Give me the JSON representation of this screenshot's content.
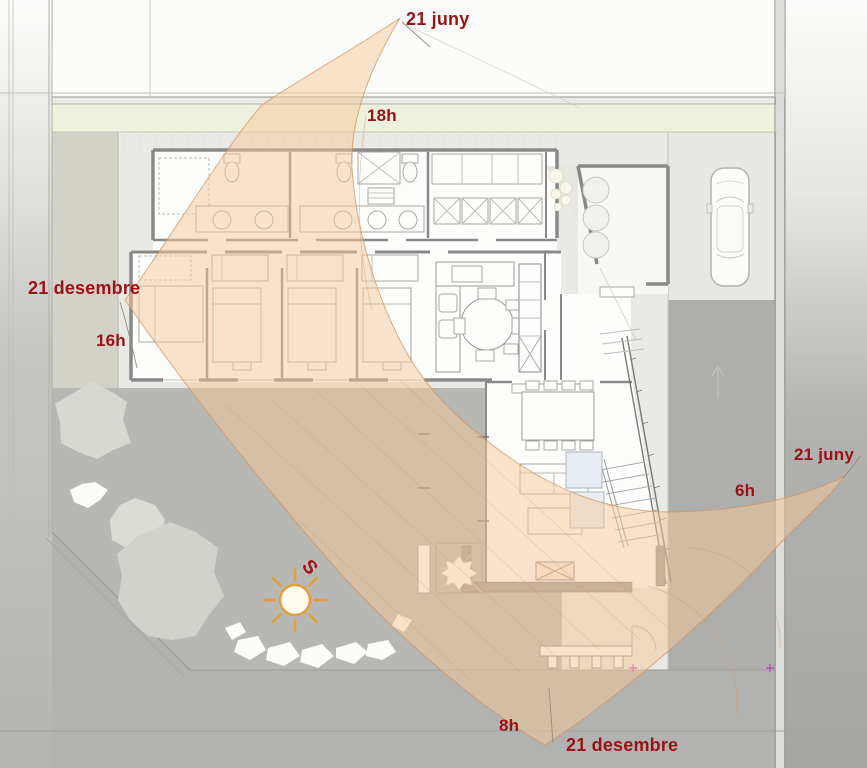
{
  "scene": {
    "description": "Solar path study (sun band between 21 June and 21 December arcs) over a single-storey house site plan",
    "language": "Catalan"
  },
  "labels": {
    "june_top": "21 juny",
    "hour_18": "18h",
    "december_left": "21 desembre",
    "hour_16": "16h",
    "june_right": "21 juny",
    "hour_6": "6h",
    "hour_8": "8h",
    "december_bottom": "21 desembre",
    "south": "S"
  },
  "colors": {
    "label_red": "#9c1115",
    "sun_band_fill": "#f6c79a",
    "sun_band_edge": "#cf9464",
    "sun_disc": "#fffbee",
    "sun_rays": "#e29d3e",
    "garden_gray": "#b7b7b4",
    "street_gray": "#b2b2b0",
    "green_strip": "#eff1df",
    "wall_gray": "#898989"
  },
  "icons": {
    "sun": "sun-icon",
    "car": "car-top-view-icon",
    "trees": "tree-canopy-icon",
    "south_marker": "south-letter"
  }
}
